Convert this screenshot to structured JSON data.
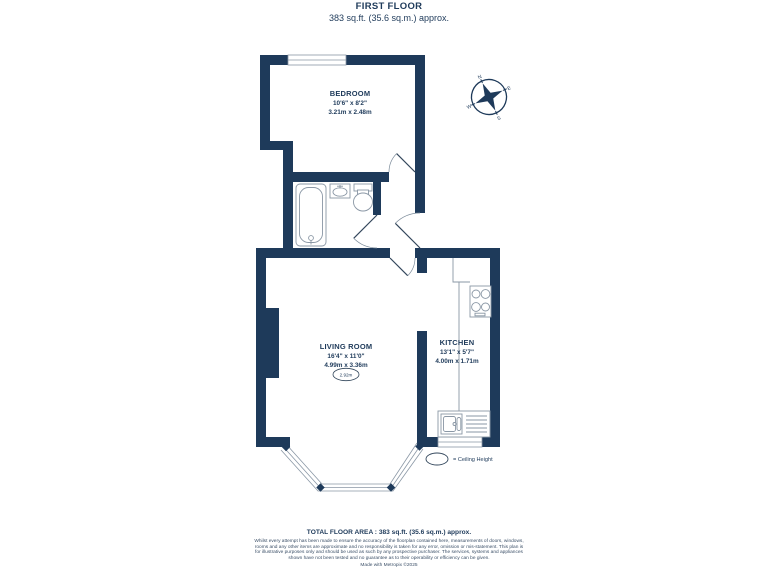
{
  "title": {
    "line1": "FIRST FLOOR",
    "line2": "383 sq.ft. (35.6 sq.m.) approx."
  },
  "rooms": {
    "bedroom": {
      "name": "BEDROOM",
      "imperial": "10'6\" x 8'2\"",
      "metric": "3.21m x 2.48m"
    },
    "living_room": {
      "name": "LIVING ROOM",
      "imperial": "16'4\" x 11'0\"",
      "metric": "4.99m x 3.36m",
      "ceiling_height": "2.92m"
    },
    "kitchen": {
      "name": "KITCHEN",
      "imperial": "13'1\" x 5'7\"",
      "metric": "4.00m x 1.71m"
    }
  },
  "legend": {
    "ceiling_height_label": "= Ceiling Height"
  },
  "compass": {
    "north": "N",
    "east": "E",
    "south": "S",
    "west": "W"
  },
  "footer": {
    "total": "TOTAL FLOOR AREA : 383 sq.ft. (35.6 sq.m.) approx.",
    "disclaimer": "Whilst every attempt has been made to ensure the accuracy of the floorplan contained here, measurements of doors, windows, rooms and any other items are approximate and no responsibility is taken for any error, omission or mis-statement. This plan is for illustrative purposes only and should be used as such by any prospective purchaser. The services, systems and appliances shown have not been tested and no guarantee as to their operability or efficiency can be given.",
    "credit": "Made with Metropix ©2025"
  },
  "colors": {
    "wall": "#1e3a5a",
    "fixture_line": "#8a97a5",
    "text": "#1e3a5a"
  }
}
